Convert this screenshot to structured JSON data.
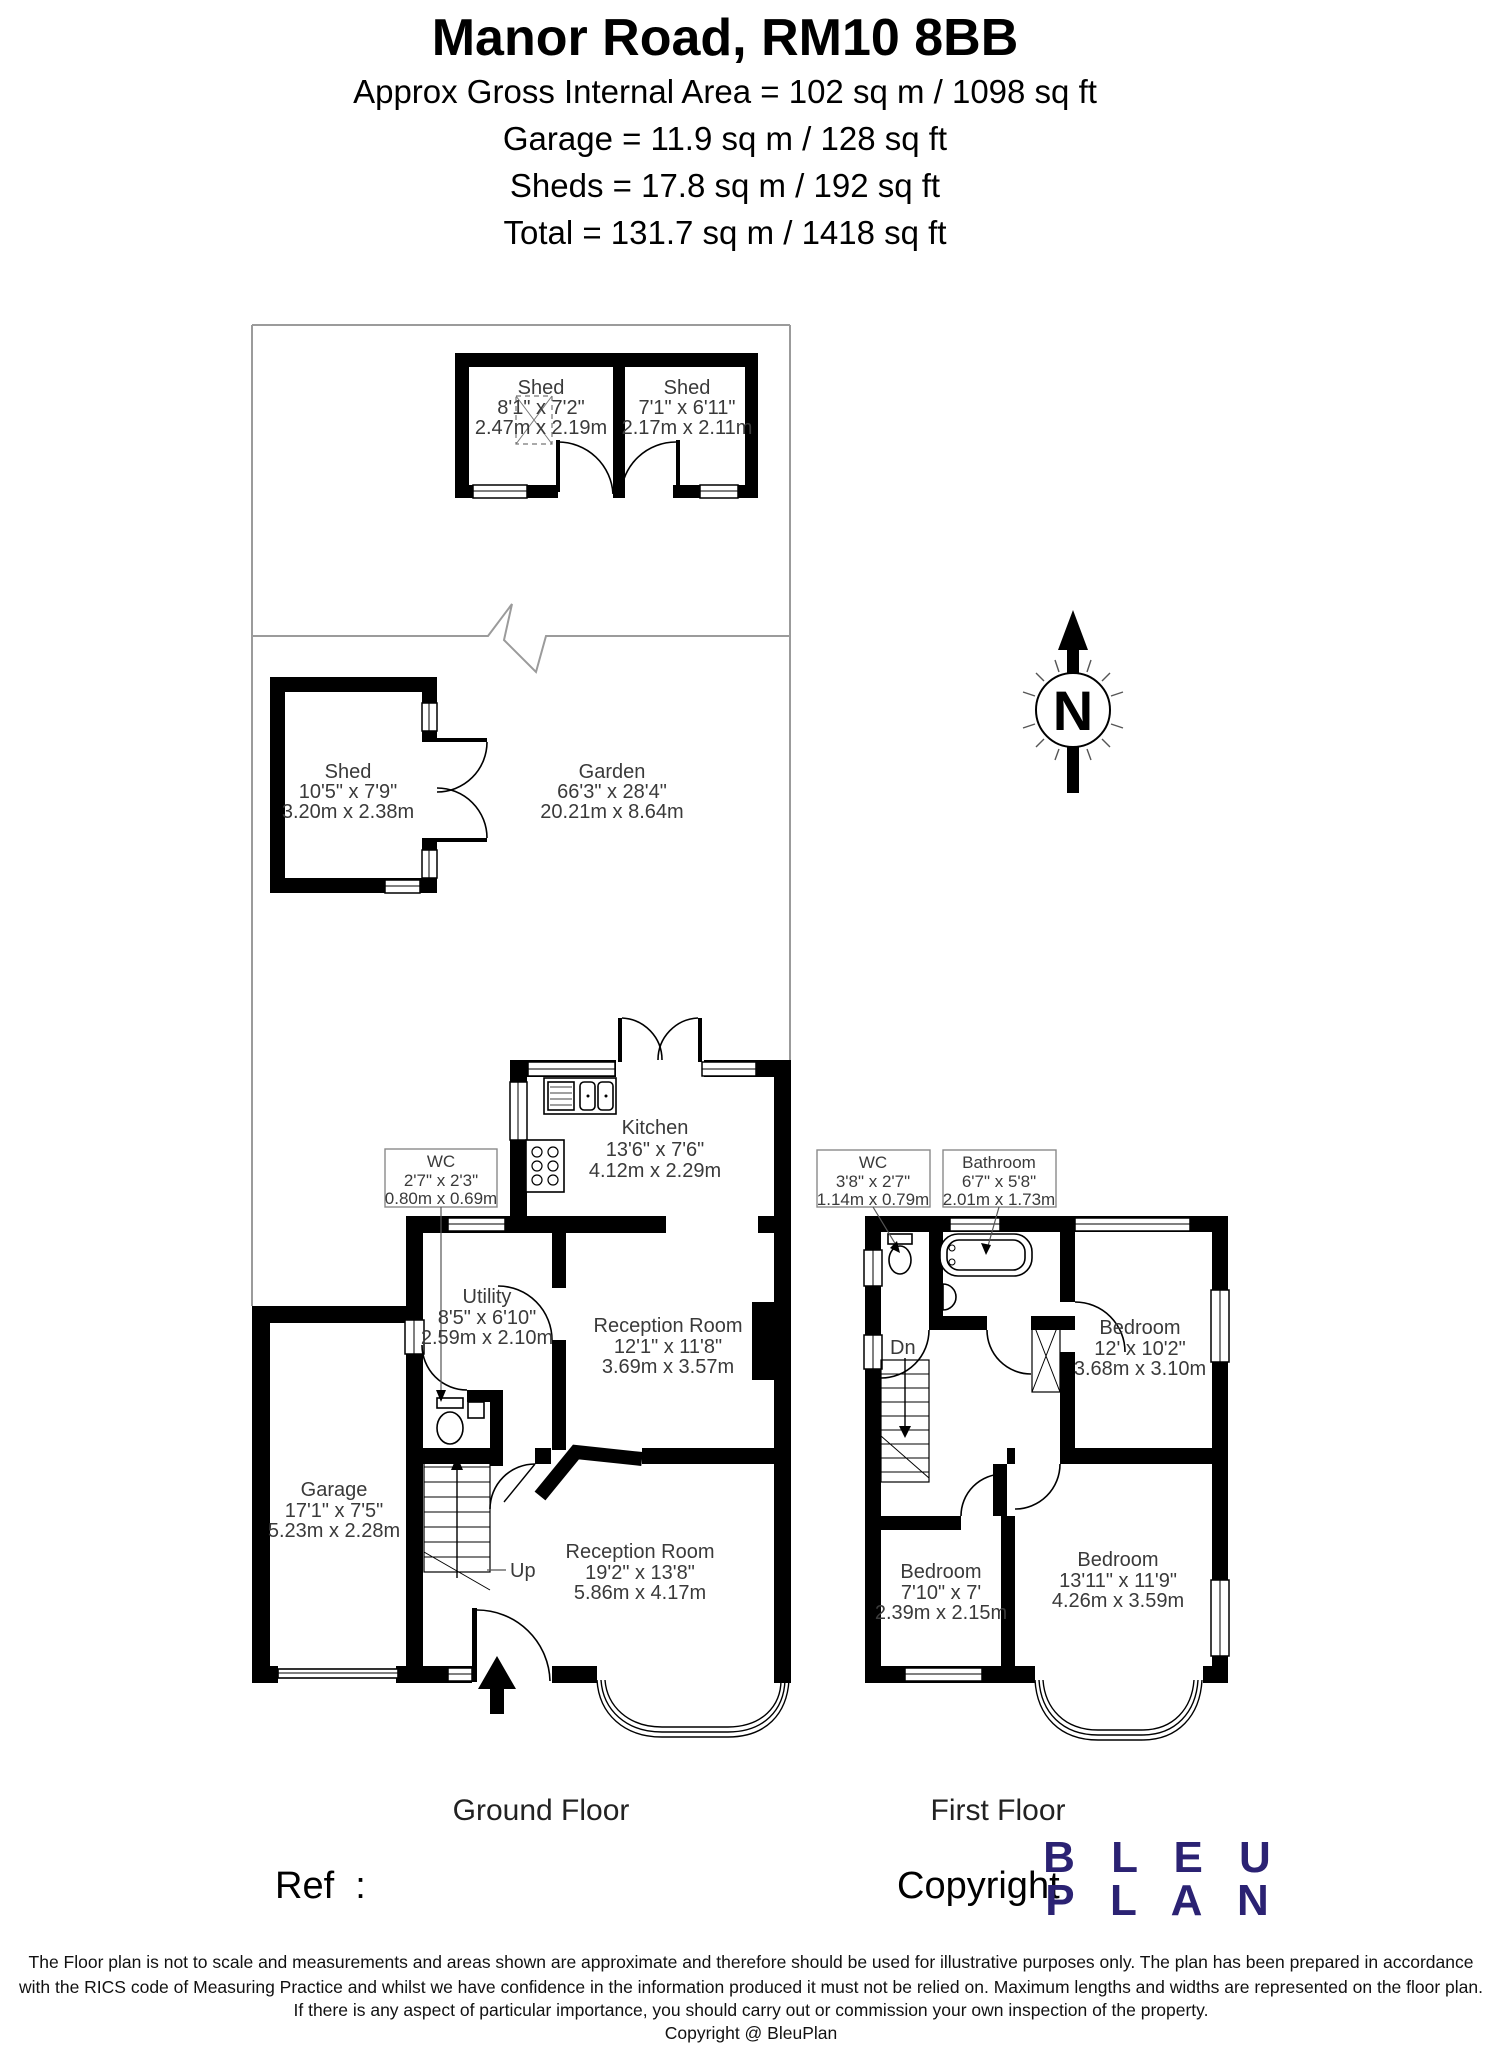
{
  "header": {
    "title": "Manor Road, RM10 8BB",
    "area_line": "Approx Gross Internal Area = 102 sq m / 1098 sq ft",
    "garage_line": "Garage = 11.9 sq m / 128 sq ft",
    "sheds_line": "Sheds = 17.8 sq m / 192 sq ft",
    "total_line": "Total = 131.7 sq m / 1418 sq ft"
  },
  "compass": {
    "north_label": "N"
  },
  "rooms": {
    "shed_top_left": {
      "name": "Shed",
      "imperial": "8'1\" x 7'2\"",
      "metric": "2.47m x 2.19m"
    },
    "shed_top_right": {
      "name": "Shed",
      "imperial": "7'1\" x 6'11\"",
      "metric": "2.17m x 2.11m"
    },
    "shed_garden": {
      "name": "Shed",
      "imperial": "10'5\" x 7'9\"",
      "metric": "3.20m x 2.38m"
    },
    "garden": {
      "name": "Garden",
      "imperial": "66'3\" x 28'4\"",
      "metric": "20.21m x 8.64m"
    },
    "wc_ground": {
      "name": "WC",
      "imperial": "2'7\" x 2'3\"",
      "metric": "0.80m x 0.69m"
    },
    "kitchen": {
      "name": "Kitchen",
      "imperial": "13'6\" x 7'6\"",
      "metric": "4.12m x 2.29m"
    },
    "utility": {
      "name": "Utility",
      "imperial": "8'5\" x 6'10\"",
      "metric": "2.59m x 2.10m"
    },
    "reception1": {
      "name": "Reception Room",
      "imperial": "12'1\" x 11'8\"",
      "metric": "3.69m x 3.57m"
    },
    "garage": {
      "name": "Garage",
      "imperial": "17'1\" x 7'5\"",
      "metric": "5.23m x 2.28m"
    },
    "reception2": {
      "name": "Reception Room",
      "imperial": "19'2\" x 13'8\"",
      "metric": "5.86m x 4.17m"
    },
    "wc_first": {
      "name": "WC",
      "imperial": "3'8\" x 2'7\"",
      "metric": "1.14m x 0.79m"
    },
    "bathroom": {
      "name": "Bathroom",
      "imperial": "6'7\" x 5'8\"",
      "metric": "2.01m x 1.73m"
    },
    "bedroom1": {
      "name": "Bedroom",
      "imperial": "12' x 10'2\"",
      "metric": "3.68m x 3.10m"
    },
    "bedroom2": {
      "name": "Bedroom",
      "imperial": "7'10\" x 7'",
      "metric": "2.39m x 2.15m"
    },
    "bedroom3": {
      "name": "Bedroom",
      "imperial": "13'11\" x 11'9\"",
      "metric": "4.26m x 3.59m"
    }
  },
  "stairs": {
    "up_label": "Up",
    "down_label": "Dn"
  },
  "floor_captions": {
    "ground": "Ground Floor",
    "first": "First Floor"
  },
  "footer": {
    "ref_label": "Ref  :",
    "copyright_label": "Copyright",
    "logo_line1": "B L E U",
    "logo_line2": "P L A N",
    "disclaimer_line1": "The Floor plan is not to scale and measurements and areas shown are approximate and therefore should be used for illustrative purposes only. The plan has been prepared in accordance",
    "disclaimer_line2": "with the RICS code of Measuring Practice and whilst we have confidence in the information produced it must not be relied on. Maximum lengths and widths are represented on the floor plan.",
    "disclaimer_line3": "If there is any aspect of particular importance, you should carry out or commission your own inspection of the property.",
    "disclaimer_line4": "Copyright @ BleuPlan"
  },
  "colors": {
    "wall": "#000000",
    "boundary": "#9b9b9b",
    "logo_navy": "#2b2273",
    "label_text": "#3a3a3a"
  }
}
